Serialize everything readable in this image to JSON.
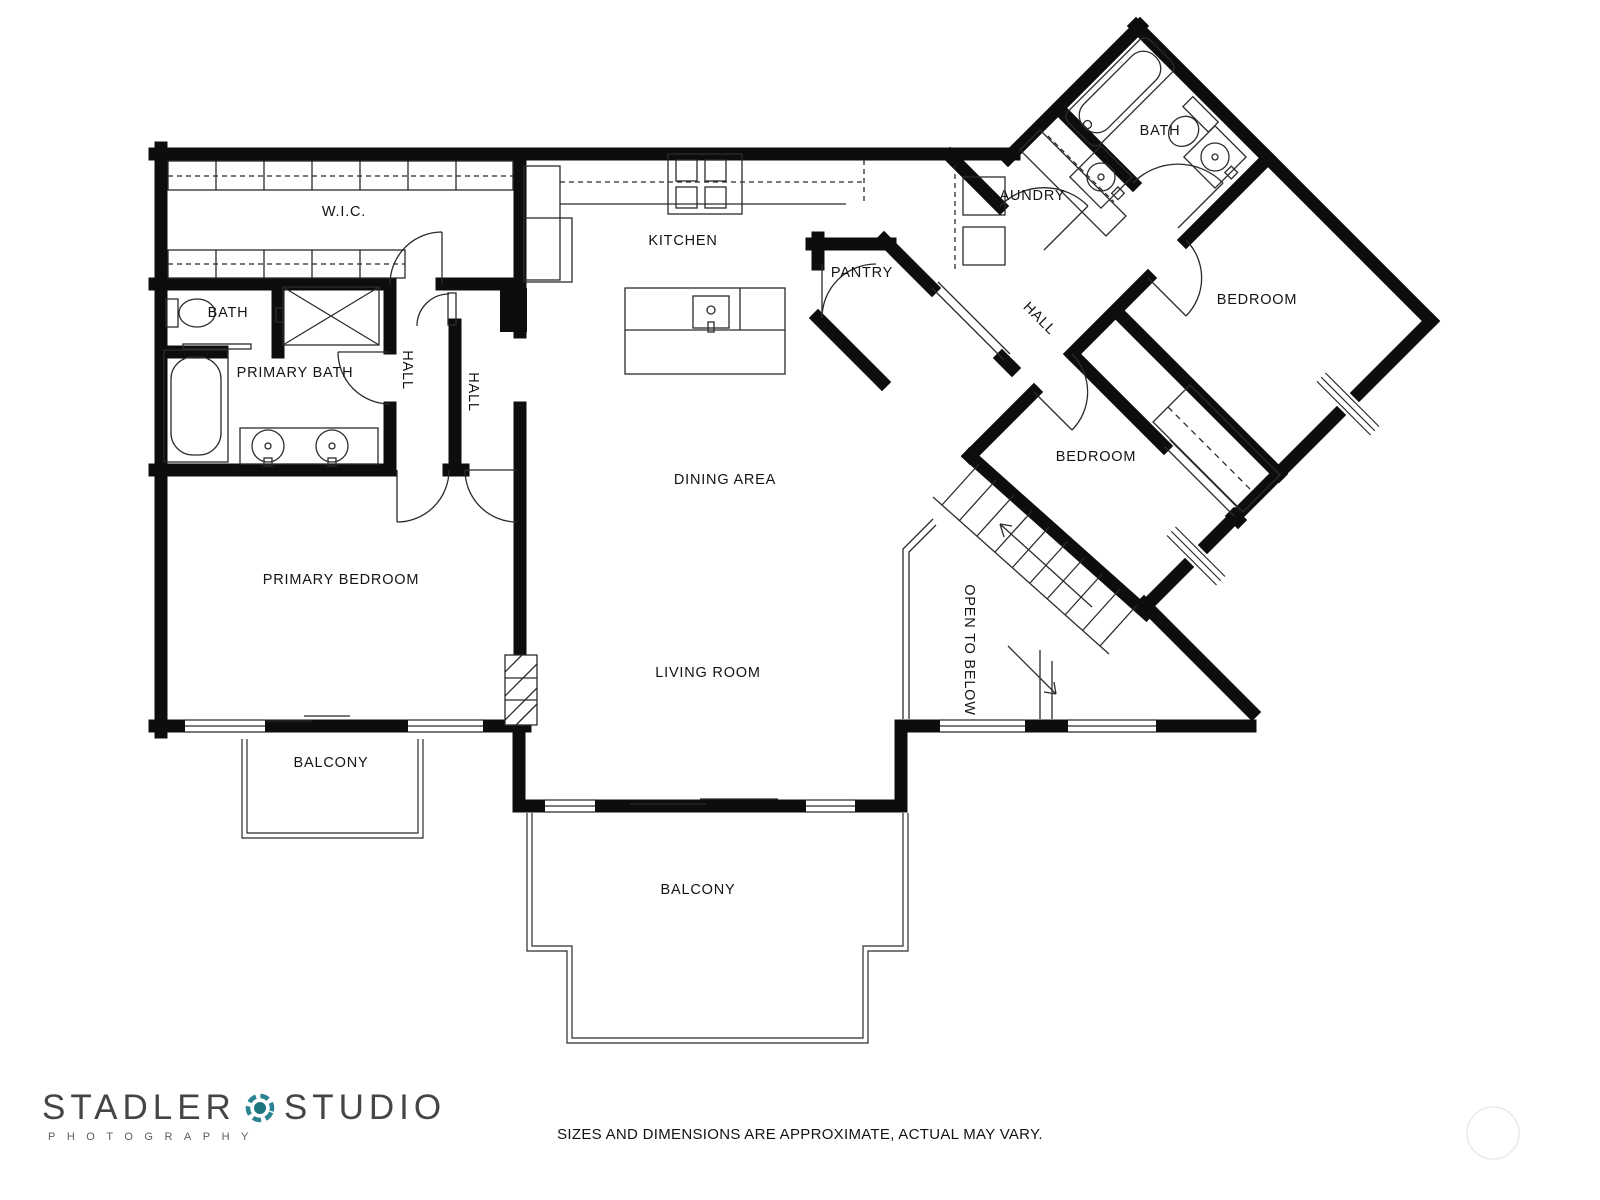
{
  "plan": {
    "wall_color": "#0d0d0d",
    "line_color": "#2b2b2b",
    "labels": [
      {
        "id": "wic",
        "text": "W.I.C."
      },
      {
        "id": "kitchen",
        "text": "KITCHEN"
      },
      {
        "id": "pantry",
        "text": "PANTRY"
      },
      {
        "id": "laundry",
        "text": "LAUNDRY"
      },
      {
        "id": "bath-top",
        "text": "BATH"
      },
      {
        "id": "hall-diagonal",
        "text": "HALL"
      },
      {
        "id": "bath-left",
        "text": "BATH"
      },
      {
        "id": "primary-bath",
        "text": "PRIMARY BATH"
      },
      {
        "id": "hall-1",
        "text": "HALL"
      },
      {
        "id": "hall-2",
        "text": "HALL"
      },
      {
        "id": "bedroom-top",
        "text": "BEDROOM"
      },
      {
        "id": "bedroom-middle",
        "text": "BEDROOM"
      },
      {
        "id": "dining-area",
        "text": "DINING AREA"
      },
      {
        "id": "primary-bedroom",
        "text": "PRIMARY BEDROOM"
      },
      {
        "id": "living-room",
        "text": "LIVING ROOM"
      },
      {
        "id": "open-to-below",
        "text": "OPEN TO BELOW"
      },
      {
        "id": "balcony-left",
        "text": "BALCONY"
      },
      {
        "id": "balcony-main",
        "text": "BALCONY"
      }
    ]
  },
  "footer": {
    "logo": {
      "word1": "STADLER",
      "word2": "STUDIO",
      "subtitle": "PHOTOGRAPHY",
      "accent_color": "#24808c"
    },
    "disclaimer": "SIZES AND DIMENSIONS ARE APPROXIMATE, ACTUAL MAY VARY."
  }
}
